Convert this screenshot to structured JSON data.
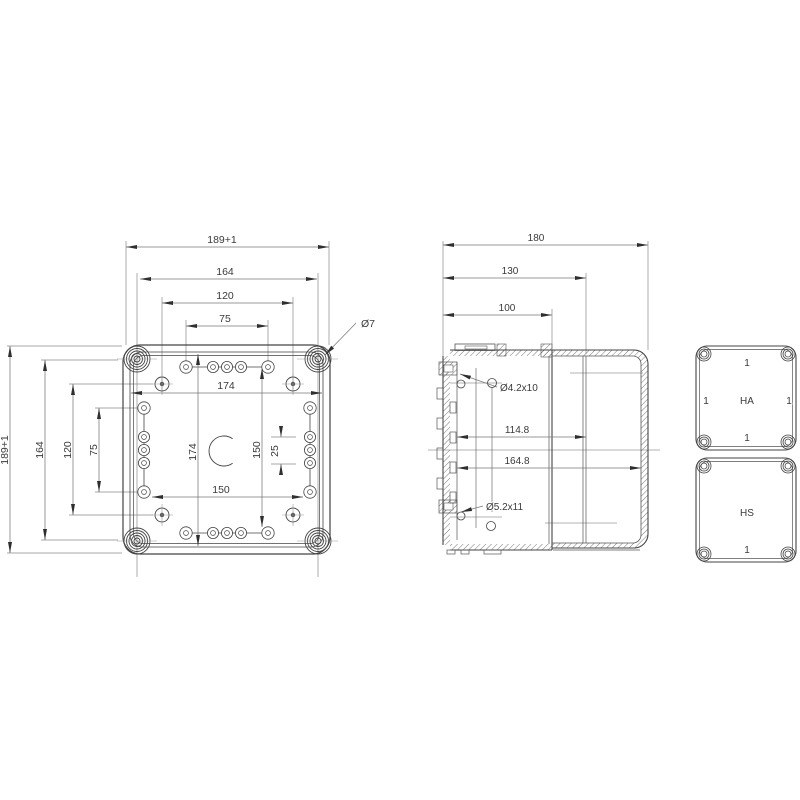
{
  "page": {
    "background": "#ffffff"
  },
  "colors": {
    "outline": "#444444",
    "dimension_line": "#777777",
    "extension_line": "#8a8a8a",
    "centerline": "#9a9a9a",
    "text": "#3a3a3a",
    "hatch": "#555555"
  },
  "front_view": {
    "width_dims": {
      "outer": "189+1",
      "bosses": "164",
      "plate": "120",
      "slots": "75"
    },
    "height_dims": {
      "outer": "189+1",
      "bosses": "164",
      "plate": "120",
      "slots": "75"
    },
    "inner_dims": {
      "width": "174",
      "height": "174",
      "right_span": "150",
      "hole_pitch": "25",
      "bottom_span": "150"
    },
    "corner_hole_label": "Ø7"
  },
  "section_view": {
    "depth_dims": {
      "overall": "180",
      "to_rim": "130",
      "to_base_edge": "100",
      "inner_base": "114.8",
      "inner_total": "164.8"
    },
    "hole_labels": {
      "top": "Ø4.2x10",
      "bottom": "Ø5.2x11"
    }
  },
  "lid_views": {
    "ha": {
      "title": "HA",
      "screw_top": "1",
      "screw_left": "1",
      "screw_right": "1",
      "screw_bottom": "1"
    },
    "hs": {
      "title": "HS",
      "screw_bottom": "1"
    }
  }
}
